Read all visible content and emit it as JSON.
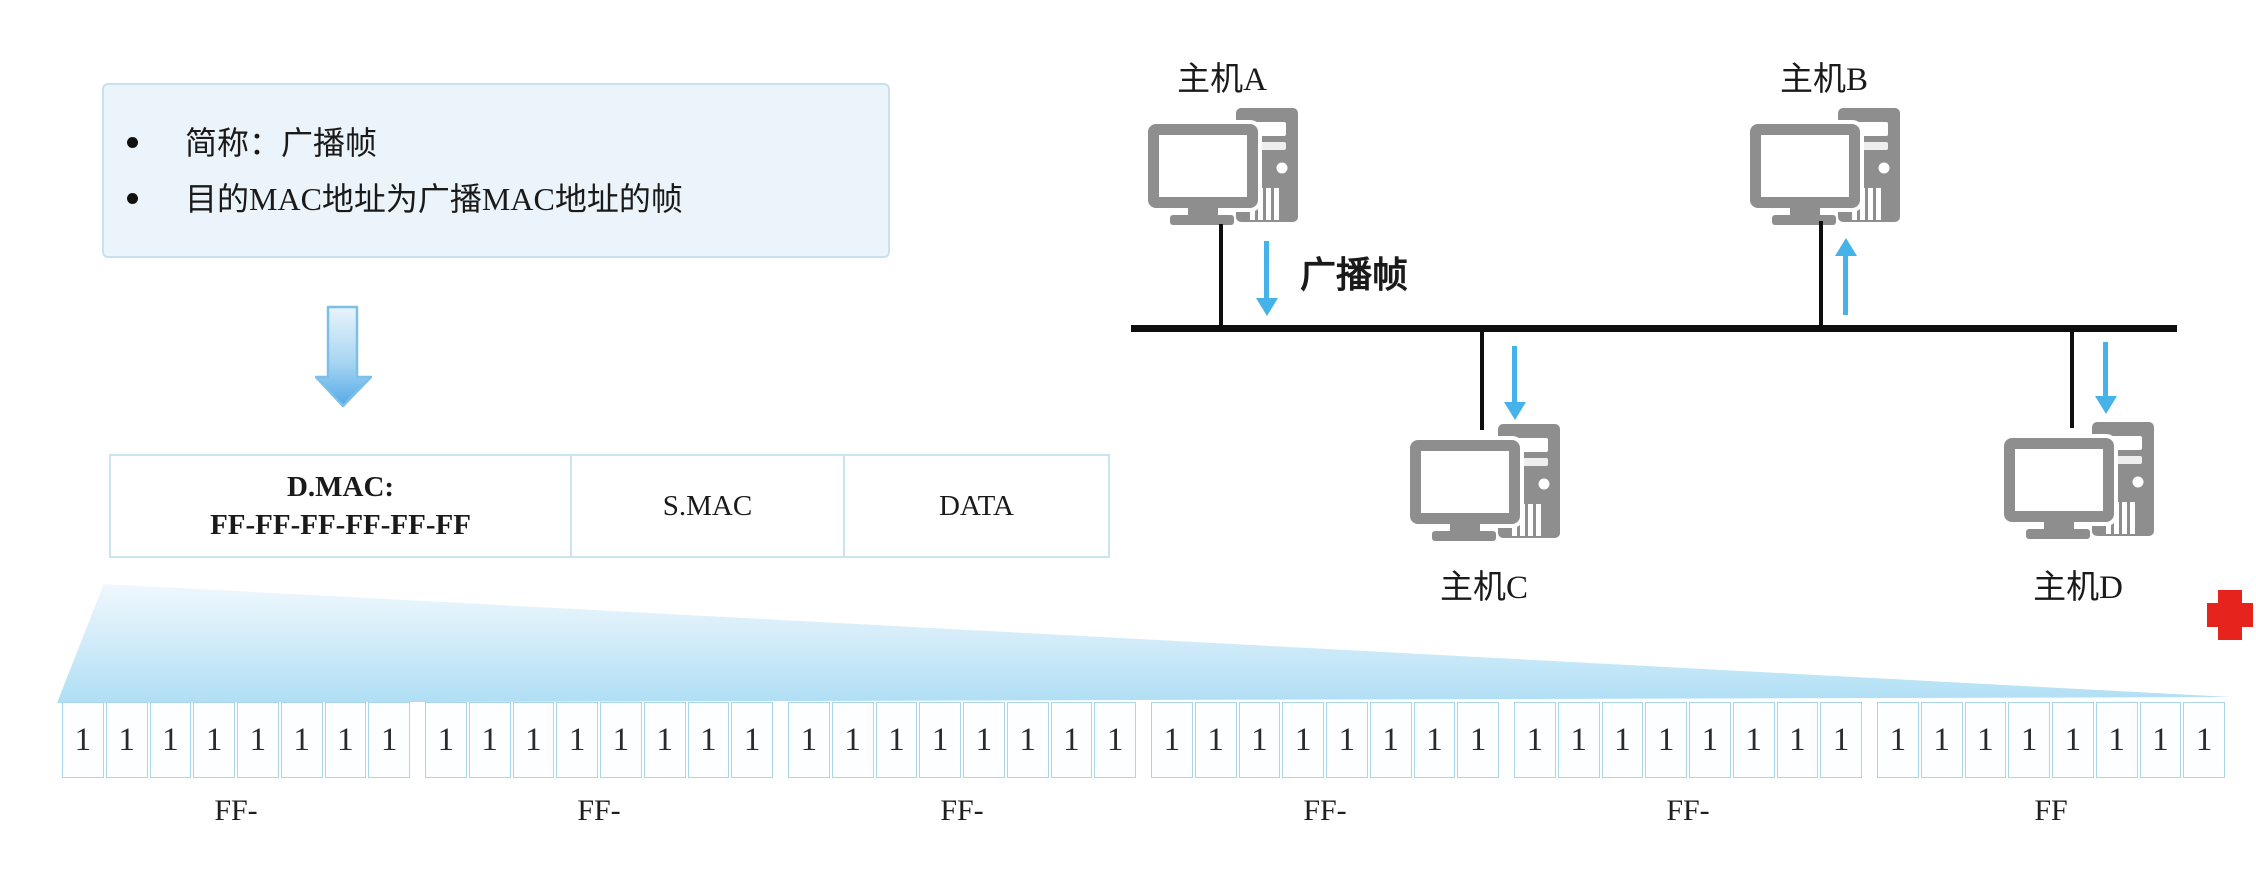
{
  "info_box": {
    "bullets": [
      "简称：广播帧",
      "目的MAC地址为广播MAC地址的帧"
    ]
  },
  "frame_table": {
    "dmac_line1": "D.MAC:",
    "dmac_line2": "FF-FF-FF-FF-FF-FF",
    "smac": "S.MAC",
    "data": "DATA"
  },
  "bit_expansion": {
    "groups": [
      {
        "bits": [
          "1",
          "1",
          "1",
          "1",
          "1",
          "1",
          "1",
          "1"
        ],
        "label": "FF-"
      },
      {
        "bits": [
          "1",
          "1",
          "1",
          "1",
          "1",
          "1",
          "1",
          "1"
        ],
        "label": "FF-"
      },
      {
        "bits": [
          "1",
          "1",
          "1",
          "1",
          "1",
          "1",
          "1",
          "1"
        ],
        "label": "FF-"
      },
      {
        "bits": [
          "1",
          "1",
          "1",
          "1",
          "1",
          "1",
          "1",
          "1"
        ],
        "label": "FF-"
      },
      {
        "bits": [
          "1",
          "1",
          "1",
          "1",
          "1",
          "1",
          "1",
          "1"
        ],
        "label": "FF-"
      },
      {
        "bits": [
          "1",
          "1",
          "1",
          "1",
          "1",
          "1",
          "1",
          "1"
        ],
        "label": "FF"
      }
    ]
  },
  "topology": {
    "hosts": [
      {
        "label": "主机A"
      },
      {
        "label": "主机B"
      },
      {
        "label": "主机C"
      },
      {
        "label": "主机D"
      }
    ],
    "flow_label": "广播帧"
  },
  "colors": {
    "arrow_blue": "#45b3ea",
    "funnel_blue": "#b0def4",
    "box_bg": "#ebf4fa",
    "box_border": "#c7e1ef",
    "cell_border": "#abd6ea",
    "computer_gray": "#8e8e8e",
    "line_black": "#0e0e0e",
    "cross_red": "#e6231c"
  }
}
